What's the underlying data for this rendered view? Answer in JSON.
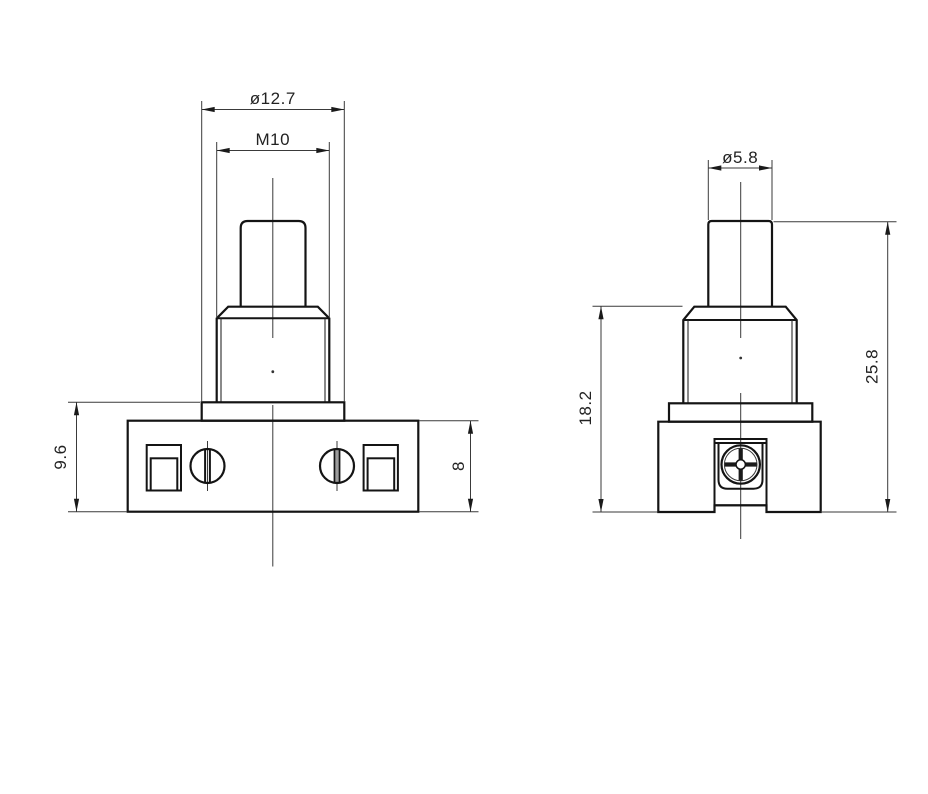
{
  "drawing": {
    "background": "#ffffff",
    "outline_color": "#141414",
    "dimension_color": "#3a3a3a",
    "text_color": "#222222",
    "dims": {
      "front": {
        "flange_dia": "ø12.7",
        "thread": "M10",
        "shoulder_height": "9.6",
        "base_height": "8"
      },
      "side": {
        "button_dia": "ø5.8",
        "body_height": "18.2",
        "total_height": "25.8"
      }
    }
  }
}
